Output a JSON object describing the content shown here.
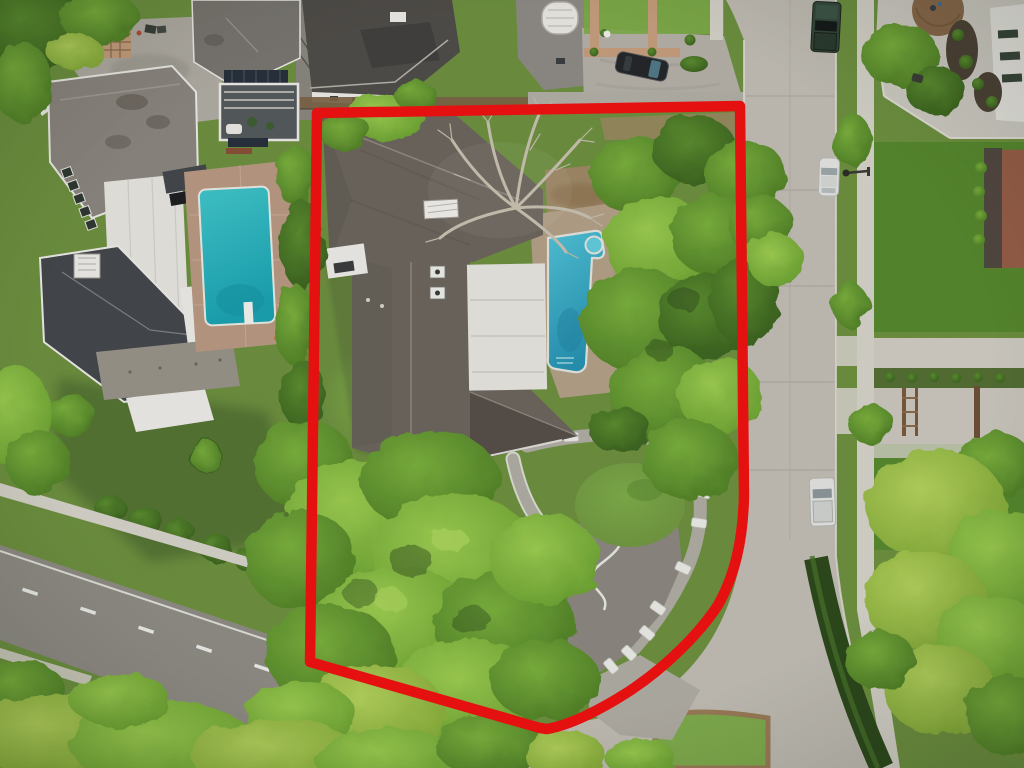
{
  "meta": {
    "kind": "aerial-drone-photograph",
    "description": "Top-down aerial photo of a suburban residential lot outlined with a thick red property boundary. Inside the boundary: a large gray-roofed house with white flat-roof section, turquoise pool, bare leafless tree, palm, lawns, curved driveway with a row of white parking stones. Surroundings: western neighbor mansion with pool, northern houses with parking court and black car, vertical concrete street with parked green truck / white car / white pickup, diagonal road at lower left, concrete intersection with grass median, eastern yards with plaza, brick houses and bright trees."
  },
  "boundary": {
    "label": "red property outline",
    "color": "#e51111",
    "width": 10.5,
    "path": "M 317 113 L 740 106 L 744 495 C 743 540 735 575 718 605 C 700 633 665 668 628 692 C 600 710 570 725 547 729 L 540 728 L 310 662 Z"
  },
  "colors": {
    "base_lawn": "#6f9241",
    "lawn_bright": "#7fae4a",
    "lawn_vivid": "#55892e",
    "lawn_shadow": "#4a662e",
    "tree_bright_hi": "#9ecf52",
    "tree_bright_lo": "#6ba232",
    "tree_mid_hi": "#7cb23e",
    "tree_mid_lo": "#4f7f27",
    "tree_dark_hi": "#5d8f31",
    "tree_dark_lo": "#3a611f",
    "tree_yellow_hi": "#b5d45e",
    "tree_yellow_lo": "#84ab38",
    "hedge_dark": "#2e4a1d",
    "hedge_light": "#47702c",
    "street": "#c3bfb6",
    "street_seam": "#a9a59c",
    "road_dark": "#918e87",
    "sidewalk": "#d7d4cb",
    "plaza": "#d0cdc5",
    "driveway_grey": "#b2aea5",
    "motor_court": "#8e8a82",
    "roof_main": "#6e675f",
    "roof_main_dark": "#57504a",
    "roof_west_nw": "#8d8781",
    "roof_west_dark": "#45484c",
    "roof_north_a": "#7b7772",
    "roof_north_b": "#514e4a",
    "roof_north_c": "#908d87",
    "white_wall": "#efeeea",
    "white_roof": "#e9e7e2",
    "deck_tan": "#b5a28a",
    "deck_brick": "#bb9b84",
    "dirt": "#a18a67",
    "dirt_dark": "#8a6f4e",
    "fence_brown": "#7d6547",
    "wall_gray": "#b4b0a7",
    "terrace_stone": "#9a958b",
    "mulch": "#4e4337",
    "pool_west_hi": "#41c8cc",
    "pool_west_lo": "#1ba4b4",
    "pool_east_hi": "#52c5da",
    "pool_east_lo": "#2794b4",
    "pool_spa": "#63cede",
    "stone_white": "#edeee9",
    "brick_path": "#c8a07e",
    "brick_house": "#99604a",
    "car_black": "#26282b",
    "truck_green": "#35493d",
    "car_white": "#e6e7e4",
    "glass_teal": "#54808c",
    "lane_white": "#eef0ec",
    "branch_pale": "#cbc3b3"
  },
  "objects": [
    {
      "name": "property-boundary",
      "note": "thick red outline, square top corners, curved lower-right corner following the street"
    },
    {
      "name": "subject-house",
      "note": "large gray cross-shaped shingle roof with white flat roof section, skylight box, two AC units"
    },
    {
      "name": "subject-pool",
      "note": "turquoise pool with round spa, tan deck, partially hidden by trees"
    },
    {
      "name": "bare-tree",
      "note": "leafless pale-branched tree over the roof"
    },
    {
      "name": "palm-tree",
      "note": "small palm near pool"
    },
    {
      "name": "subject-driveway",
      "note": "curved drive with motor court, white-edged walk and 14 white parking stones"
    },
    {
      "name": "west-neighbor-house",
      "note": "white mansion, taupe and charcoal roofs, white center roof strip, trellis, pool with diving board"
    },
    {
      "name": "north-houses",
      "note": "three houses, glass deck with solar panels, parking court with black car, tan front-path grid"
    },
    {
      "name": "vertical-street",
      "note": "concrete street, right side parking: dark green truck, white car, white pickup, street lamp"
    },
    {
      "name": "diagonal-road",
      "note": "darker asphalt road lower-left with dashed center line"
    },
    {
      "name": "intersection",
      "note": "concrete junction with grass median island and white dashes"
    },
    {
      "name": "east-yards",
      "note": "sidewalk, vivid lawns, concrete plaza with brown planter circle, two brick houses, gated driveways, bright trees, dark hedge curve"
    }
  ]
}
